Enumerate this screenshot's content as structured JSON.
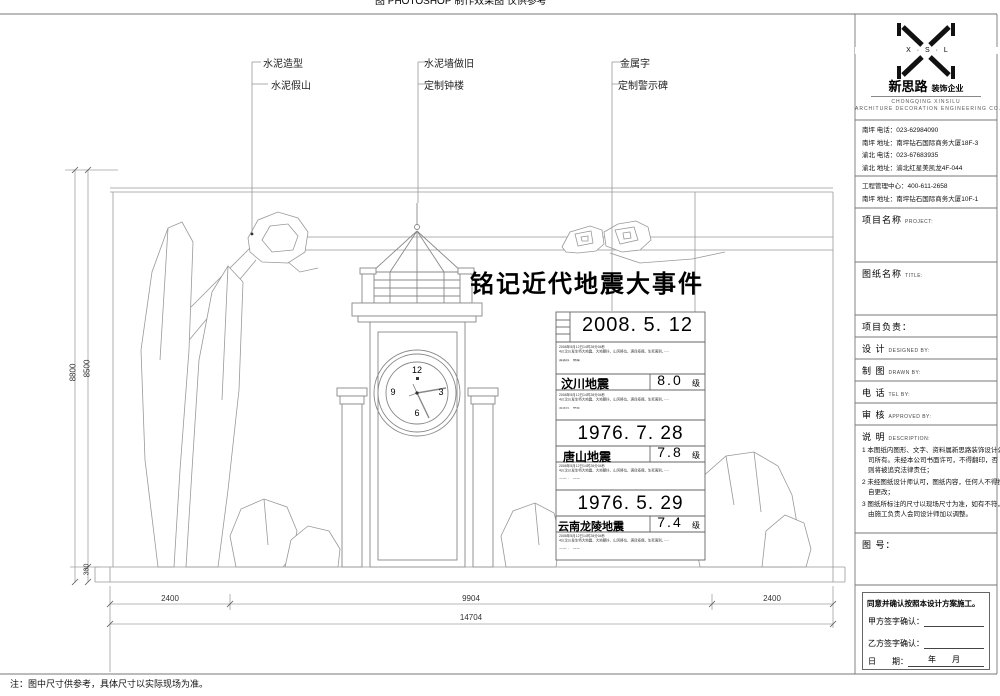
{
  "sheet": {
    "top_clipped_text": "图 PHOTOSHOP 制作效果图 仅供参考"
  },
  "callouts": {
    "c1a": "水泥造型",
    "c1b": "水泥假山",
    "c2a": "水泥墙做旧",
    "c2b": "定制钟楼",
    "c3a": "金属字",
    "c3b": "定制警示碑"
  },
  "drawing": {
    "main_title": "铭记近代地震大事件",
    "clock": {
      "n12": "12",
      "n3": "3",
      "n6": "6",
      "n9": "9"
    },
    "panels": [
      {
        "date": "2008. 5. 12",
        "name": "汶川地震",
        "magnitude": "8.0",
        "unit": "级"
      },
      {
        "date": "1976. 7. 28",
        "name": "唐山地震",
        "magnitude": "7.8",
        "unit": "级"
      },
      {
        "date": "1976. 5. 29",
        "name": "云南龙陵地震",
        "magnitude": "7.4",
        "unit": "级"
      }
    ],
    "panel_note_text": "2008年5月12日14时28分04秒\n4川汶川发生特大地震、大地颤抖、山河移位、满目疮痍、生死离别、·····\n\n西南处，国殇。\n是新中国成立以来破坏性最强、波及范围最大的一次地震，\n影响重达10万平方公里的中国大地",
    "dims": {
      "left_outer": "8800",
      "left_inner": "8500",
      "left_bottom": "300",
      "bottom_left": "2400",
      "bottom_mid": "9904",
      "bottom_right": "2400",
      "bottom_total": "14704"
    },
    "footnote": "注：图中尺寸供参考，具体尺寸以实际现场为准。"
  },
  "title_block": {
    "logo": {
      "monogram": "X · S · L",
      "name_cn": "新思路",
      "name_tag": "装饰企业",
      "name_en1": "CHONGQING  XINSILU",
      "name_en2": "ARCHITURE  DECORATION  ENGINEERING  CO."
    },
    "contacts1": [
      "南坪  电话：023-62984090",
      "南坪  地址：南坪钻石国际商务大厦18F-3",
      "渝北  电话：023-67683935",
      "渝北  地址：渝北红星美凯龙4F-044"
    ],
    "contacts2": [
      "工程管理中心：400-611-2658",
      "南坪  地址：南坪钻石国际商务大厦10F-1"
    ],
    "project_label": "项目名称",
    "project_en": "PROJECT:",
    "sheet_title_label": "图纸名称",
    "sheet_title_en": "TITLE:",
    "leader_label": "项目负责：",
    "rows": [
      {
        "cn": "设  计",
        "en": "DESIGNED BY:"
      },
      {
        "cn": "制  图",
        "en": "DRAWN BY:"
      },
      {
        "cn": "电  话",
        "en": "TEL BY:"
      },
      {
        "cn": "审  核",
        "en": "APPROVED BY:"
      }
    ],
    "desc_label": "说  明",
    "desc_en": "DESCRIPTION:",
    "notes": [
      "1 本图纸内图形、文字、资料属新思路装饰设计公司所有。未经本公司书面许可，不得翻印，否则将被追究法律责任；",
      "2 未经图纸设计师认可，图纸内容，任何人不得擅自更改；",
      "3 图纸所标注的尺寸以现场尺寸为准，如有不符，由施工负责人会同设计师加以调整。"
    ],
    "sheet_no_label": "图 号：",
    "signoff": {
      "statement": "同意并确认按照本设计方案施工。",
      "party_a": "甲方签字确认：",
      "party_b": "乙方签字确认：",
      "date_label": "日　　期：",
      "date_value": "年　月"
    }
  }
}
